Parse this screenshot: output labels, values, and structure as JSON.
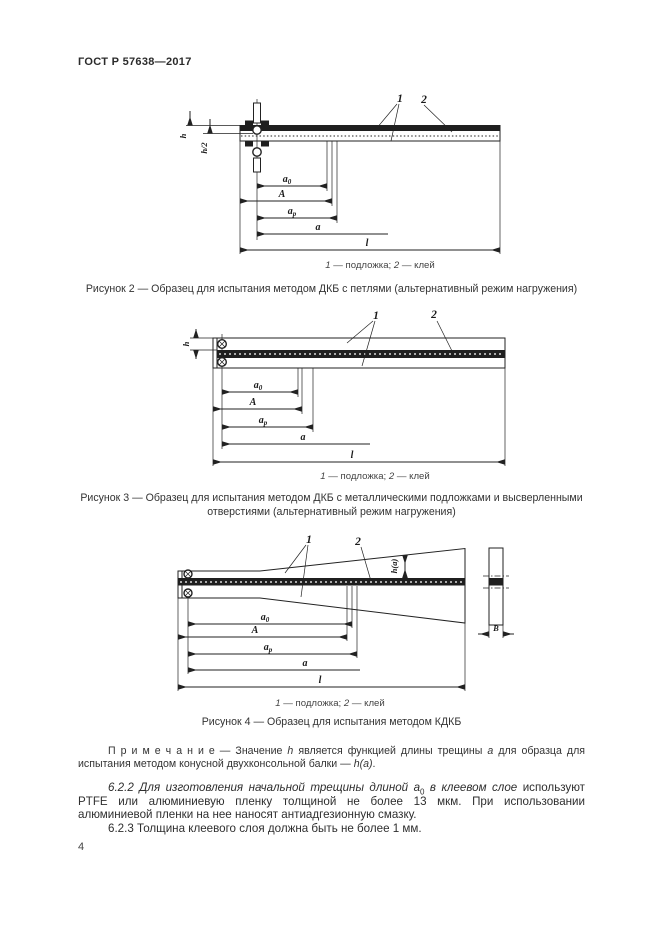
{
  "header": {
    "standard": "ГОСТ Р 57638—2017"
  },
  "shared": {
    "legend": {
      "n1": "1",
      "mid": " — подложка; ",
      "n2": "2",
      "tail": " — клей"
    }
  },
  "fig2": {
    "caption": "Рисунок 2 — Образец для испытания методом ДКБ с петлями (альтернативный режим нагружения)",
    "labels": {
      "callout1": "1",
      "callout2": "2",
      "h": "h",
      "h2": "h/2",
      "a0b": "a",
      "a0s": "0",
      "A": "A",
      "apb": "a",
      "aps": "p",
      "a": "a",
      "l": "l"
    }
  },
  "fig3": {
    "caption_line1": "Рисунок 3 — Образец для испытания методом ДКБ с металлическими подложками и высверленными",
    "caption_line2": "отверстиями (альтернативный режим нагружения)",
    "labels": {
      "callout1": "1",
      "callout2": "2",
      "h": "h",
      "a0b": "a",
      "a0s": "0",
      "A": "A",
      "apb": "a",
      "aps": "p",
      "a": "a",
      "l": "l"
    }
  },
  "fig4": {
    "caption": "Рисунок 4 — Образец для испытания методом КДКБ",
    "labels": {
      "callout1": "1",
      "callout2": "2",
      "ha": "h(a)",
      "B": "B",
      "a0b": "a",
      "a0s": "0",
      "A": "A",
      "apb": "a",
      "aps": "p",
      "a": "a",
      "l": "l"
    }
  },
  "note": {
    "label": "П р и м е ч а н и е",
    "t1": " — Значение ",
    "h": "h",
    "t2": " является функцией длины трещины ",
    "a": "a",
    "t3": " для образца для испытания методом конусной двухконсольной балки — ",
    "ha": "h(a)",
    "t4": "."
  },
  "p622": {
    "num": "6.2.2 ",
    "i1": "Для изготовления начальной трещины длиной ",
    "a0b": "a",
    "a0s": "0",
    "i2": " в клеевом слое ",
    "rest": "используют PTFE или алюминиевую пленку толщиной не более 13 мкм. При использовании алюминиевой пленки на нее наносят антиадгезионную смазку."
  },
  "p623": {
    "num": "6.2.3 ",
    "text": "Толщина клеевого слоя должна быть не более 1 мм."
  },
  "footer": {
    "page_number": "4"
  }
}
